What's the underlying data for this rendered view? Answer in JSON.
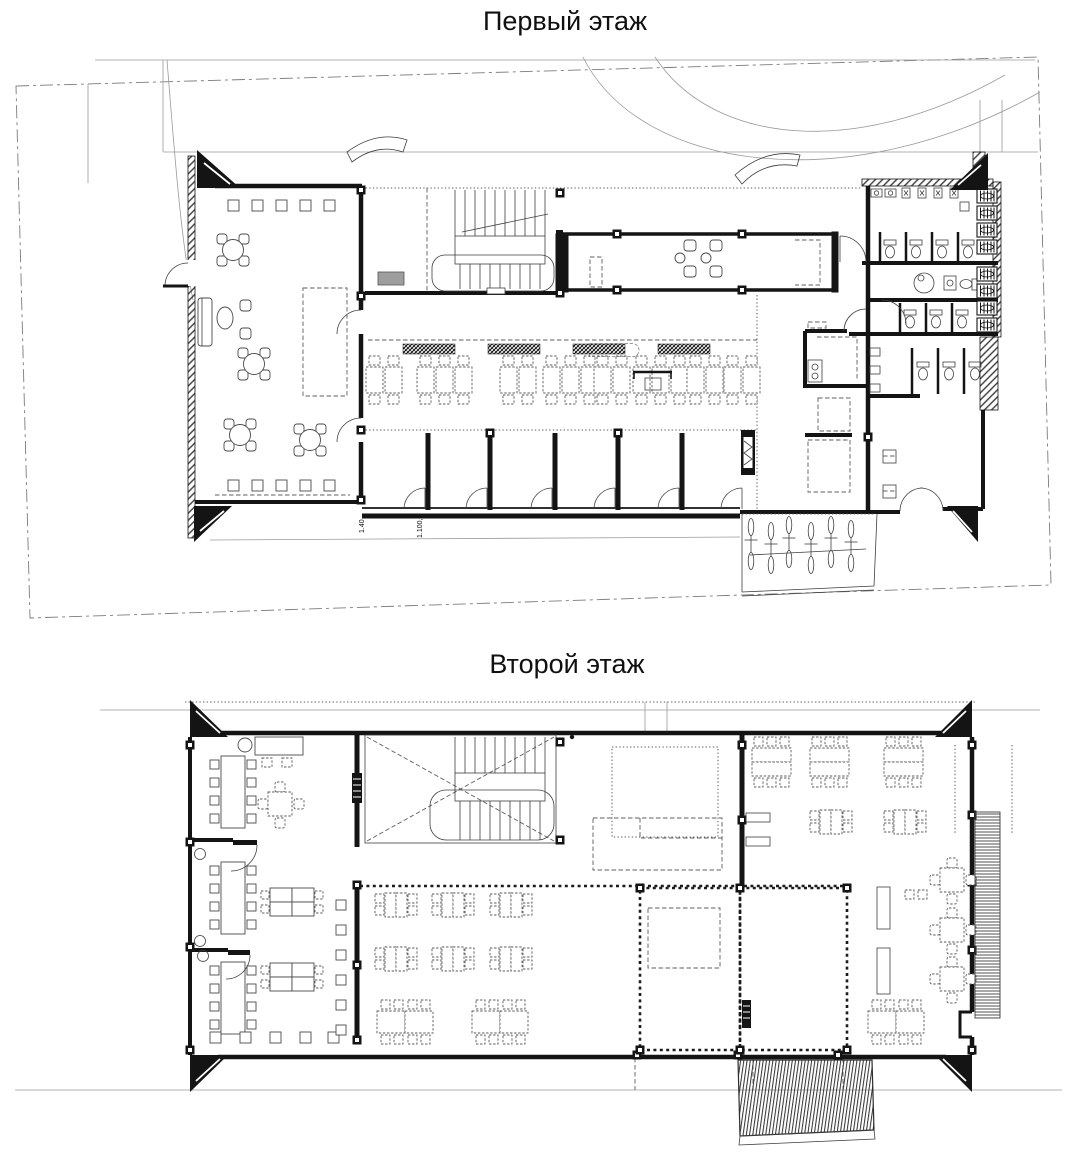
{
  "titles": {
    "first_floor": "Первый этаж",
    "second_floor": "Второй этаж"
  },
  "annotations": {
    "dim_a": "1.40",
    "dim_b": "1.100,0"
  },
  "colors": {
    "ink": "#141414",
    "site_line": "#8f8f8f",
    "furniture_line": "#5a5a5a",
    "gray_fill": "#9e9e9e",
    "background": "#ffffff"
  },
  "plans": [
    {
      "name": "Первый этаж",
      "features": [
        "site-boundary",
        "driveway-arcs",
        "entrance-lounge",
        "round-tables",
        "sofa",
        "stair-core",
        "dining-hall",
        "serving-bands",
        "booth-rooms",
        "corridor-room",
        "kitchen",
        "wc-stalls",
        "accessible-wc",
        "sinks",
        "urinals",
        "radiators",
        "bike-racks",
        "corner-markers"
      ]
    },
    {
      "name": "Второй этаж",
      "features": [
        "office-room",
        "conference-tables",
        "desk-clusters",
        "stair-core-void",
        "open-hall",
        "four-seat-tables",
        "eight-seat-tables",
        "dotted-rooms",
        "classroom",
        "service-counters",
        "balcony-hatch",
        "terrace-hatch",
        "corner-markers"
      ]
    }
  ]
}
